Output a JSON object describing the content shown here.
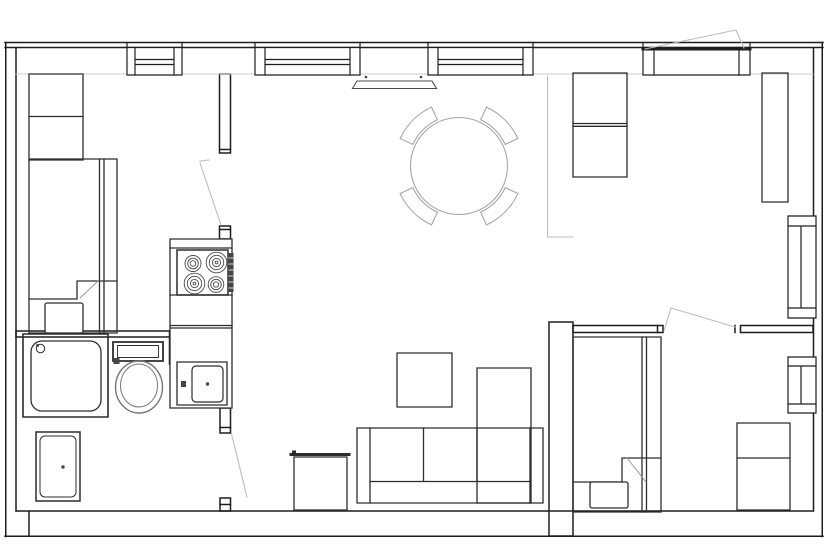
{
  "canvas": {
    "width": 830,
    "height": 555,
    "background": "#ffffff"
  },
  "colors": {
    "wall": "#1e1e1e",
    "furniture": "#2d2d2d",
    "appliance": "#454545",
    "fixture": "#777777",
    "soft_gray": "#a6a6a6",
    "swing_gray": "#bdbdbd",
    "inner_face": "#cccccc",
    "white": "#ffffff"
  },
  "plan": {
    "type": "apartment-floor-plan",
    "rooms": [
      "bedroom-left",
      "kitchen",
      "bathroom",
      "living-dining-room",
      "bedroom-right"
    ],
    "window_count": 6,
    "door_swings": [
      "kitchen-door",
      "bathroom-door",
      "bedroom-door",
      "open-casement-window"
    ],
    "furniture": [
      "wardrobe",
      "bed-left",
      "dresser",
      "tall-cabinet",
      "dining-table",
      "dining-chairs-x4",
      "radiator",
      "sofa",
      "chaise",
      "coffee-table",
      "side-table",
      "bed-right",
      "nightstand"
    ],
    "appliances": [
      "stove-4-burners",
      "kitchen-sink",
      "washing-machine"
    ],
    "fixtures": [
      "shower",
      "toilet",
      "bathroom-vanity"
    ]
  }
}
